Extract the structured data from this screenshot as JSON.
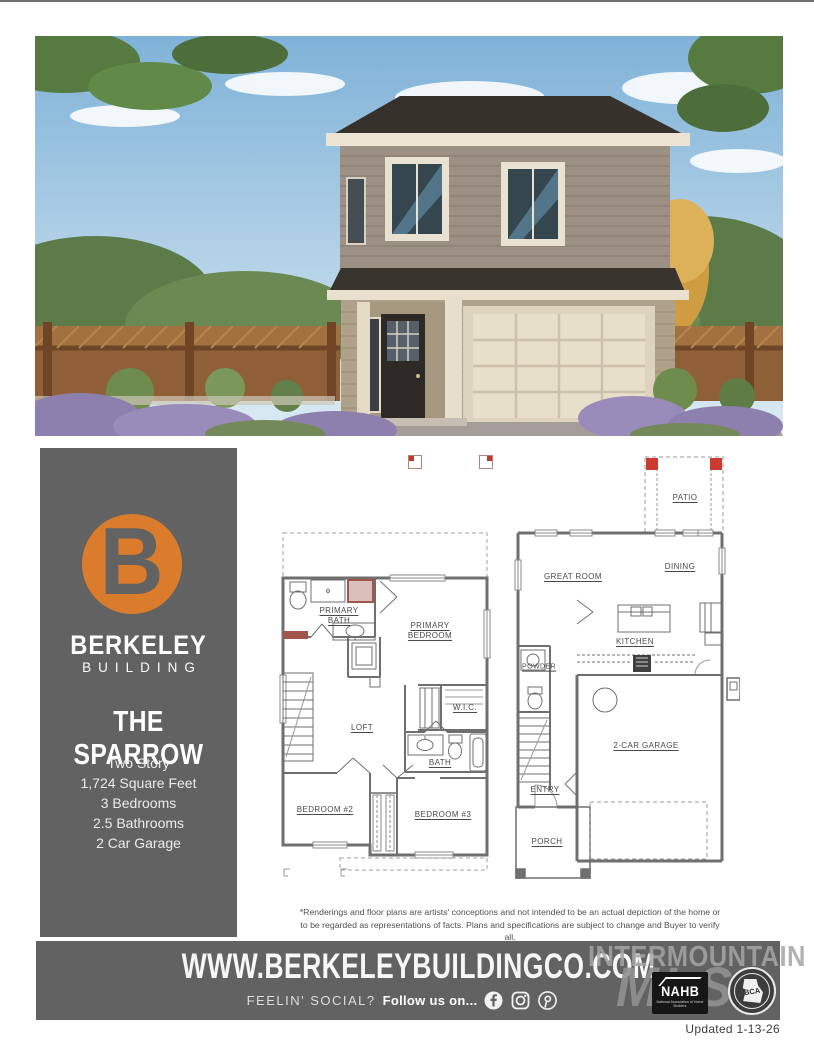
{
  "sidebar": {
    "logo_letter": "B",
    "brand_name": "BERKELEY",
    "brand_sub": "BUILDING",
    "plan_name": "THE SPARROW",
    "specs": [
      "Two Story",
      "1,724 Square Feet",
      "3 Bedrooms",
      "2.5 Bathrooms",
      "2 Car Garage"
    ]
  },
  "plans": {
    "upper": {
      "primary_bath": "PRIMARY BATH",
      "primary_bedroom": "PRIMARY BEDROOM",
      "wic": "W.I.C.",
      "loft": "LOFT",
      "bath": "BATH",
      "bedroom2": "BEDROOM #2",
      "bedroom3": "BEDROOM #3"
    },
    "main": {
      "patio": "PATIO",
      "great_room": "GREAT ROOM",
      "dining": "DINING",
      "kitchen": "KITCHEN",
      "powder": "POWDER",
      "garage": "2-CAR GARAGE",
      "entry": "ENTRY",
      "porch": "PORCH"
    }
  },
  "disclaimer": "*Renderings and floor plans are artists' conceptions and not intended to be an actual depiction of the home or to be regarded as representations of facts. Plans and specifications are subject to change and Buyer to verify all.",
  "footer": {
    "website": "WWW.BERKELEYBUILDINGCO.COM",
    "social_prefix": "FEELIN' SOCIAL?",
    "social_cta": "Follow us on...",
    "social_icons": [
      "facebook-icon",
      "instagram-icon",
      "pinterest-icon"
    ],
    "watermark_line1": "INTERMOUNTAIN",
    "watermark_line2": "MLS",
    "nahb_label": "NAHB",
    "nahb_caption": "National Association of Home Builders",
    "bca_label": "BCA",
    "updated": "Updated 1-13-26"
  },
  "colors": {
    "accent_orange": "#db7c2c",
    "panel_gray": "#626262",
    "plan_wall_gray": "#6f6f6f",
    "patio_red": "#cf3a30",
    "bath_accent_red": "#a2554c"
  }
}
